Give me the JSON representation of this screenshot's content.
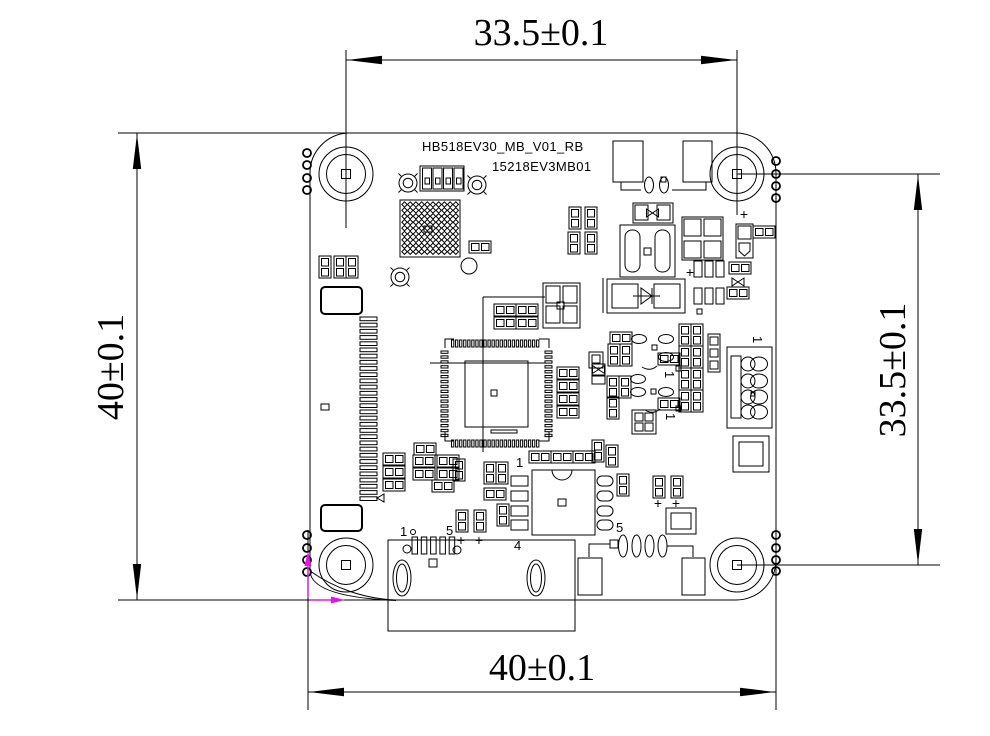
{
  "drawing": {
    "title": "HB518EV30_MB_V01_RB",
    "subtitle": "15218EV3MB01",
    "dimensions": {
      "top": "33.5±0.1",
      "left": "40±0.1",
      "right": "33.5±0.1",
      "bottom": "40±0.1"
    },
    "labels": {
      "pin1": "1",
      "pin4": "4",
      "pin5": "5",
      "plus": "+"
    },
    "colors": {
      "line": "#000000",
      "origin_marker": "#e615e6",
      "background": "#ffffff"
    }
  }
}
